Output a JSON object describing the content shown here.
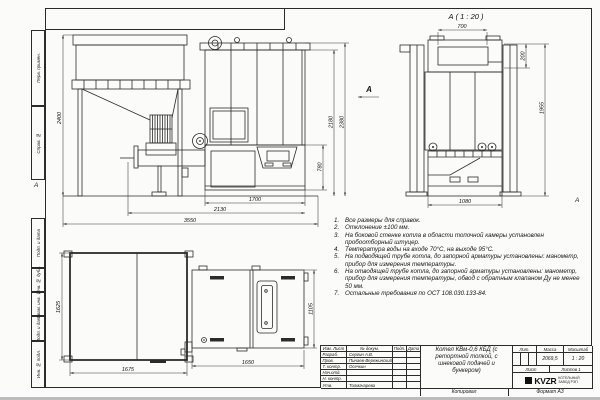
{
  "frame": {
    "left_labels": [
      {
        "label": "Перв. примен."
      },
      {
        "label": "Справ. №"
      },
      {
        "label": "Подп. и дата"
      },
      {
        "label": "Инв. № дубл."
      },
      {
        "label": "Взам. инв. №"
      },
      {
        "label": "Подп. и дата"
      },
      {
        "label": "Инв. № подл."
      }
    ],
    "zone_letter_left": "А",
    "zone_letter_right": "А",
    "bottom": {
      "copied": "Копировал",
      "format": "Формат А3"
    }
  },
  "views": {
    "front": {
      "view_label": "А",
      "dims": {
        "bunker_height": "2400",
        "inner_height": "2180",
        "overall_height": "2380",
        "base_height": "780",
        "boiler_width": "1700",
        "feed_width": "2130",
        "overall_width": "3550"
      }
    },
    "rear": {
      "title": "А ( 1 : 20 )",
      "dims": {
        "top_width": "700",
        "collector_height": "200",
        "height": "1955",
        "base_width": "1080"
      }
    },
    "plan": {
      "dims": {
        "bunker_depth": "1625",
        "bunker_width": "1675",
        "boiler_width": "1650",
        "boiler_depth": "1105"
      }
    }
  },
  "notes": {
    "items": [
      {
        "num": "1.",
        "text": "Все размеры для справок."
      },
      {
        "num": "2.",
        "text": "Отклонение ±100 мм."
      },
      {
        "num": "3.",
        "text": "На боковой стенке котла в области топочной камеры установлен пробоотборный штуцер."
      },
      {
        "num": "4.",
        "text": "Температура воды на входе 70°С, на выходе 95°С."
      },
      {
        "num": "5.",
        "text": "На подводящей трубе котла, до запорной арматуры установлены: манометр, прибор для измерения температуры."
      },
      {
        "num": "6.",
        "text": "На отводящей трубе котла, до запорной арматуры установлены: манометр, прибор для измерения температуры, обвод с обратным клапаном Ду не менее 50 мм."
      },
      {
        "num": "7.",
        "text": "Остальные требования по ОСТ 108.030.133-84."
      }
    ]
  },
  "title_block": {
    "header": {
      "izm": "Изм. Лист",
      "doc": "№ докум.",
      "sign": "Подп.",
      "date": "Дата"
    },
    "rows": [
      {
        "role": "Разраб.",
        "name": "Сергин А.В."
      },
      {
        "role": "Пров.",
        "name": "Пинаев-Вережинский"
      },
      {
        "role": "Т. контр.",
        "name": "Осечкин"
      },
      {
        "role": "Нач.отд.",
        "name": ""
      },
      {
        "role": "Н. контр.",
        "name": ""
      },
      {
        "role": "Утв.",
        "name": "Толмачарева"
      }
    ],
    "title": "Котел КВм-0,6 КБД (с ретортной топкой, с шнековой подачей и бункером)",
    "lit_label": "Лит.",
    "mass_label": "Масса",
    "mass_value": "2069,5",
    "scale_label": "Масштаб",
    "scale_value": "1 : 20",
    "sheet_label": "Лист",
    "sheets_label": "Листов 1",
    "logo_text": "KVZR",
    "logo_caption_line1": "КОТЕЛЬНЫЙ",
    "logo_caption_line2": "ЗАВОД РЭП"
  },
  "colors": {
    "paper": "#fbfbf9",
    "line": "#2b2b2b",
    "dim": "#3a3a3a"
  }
}
